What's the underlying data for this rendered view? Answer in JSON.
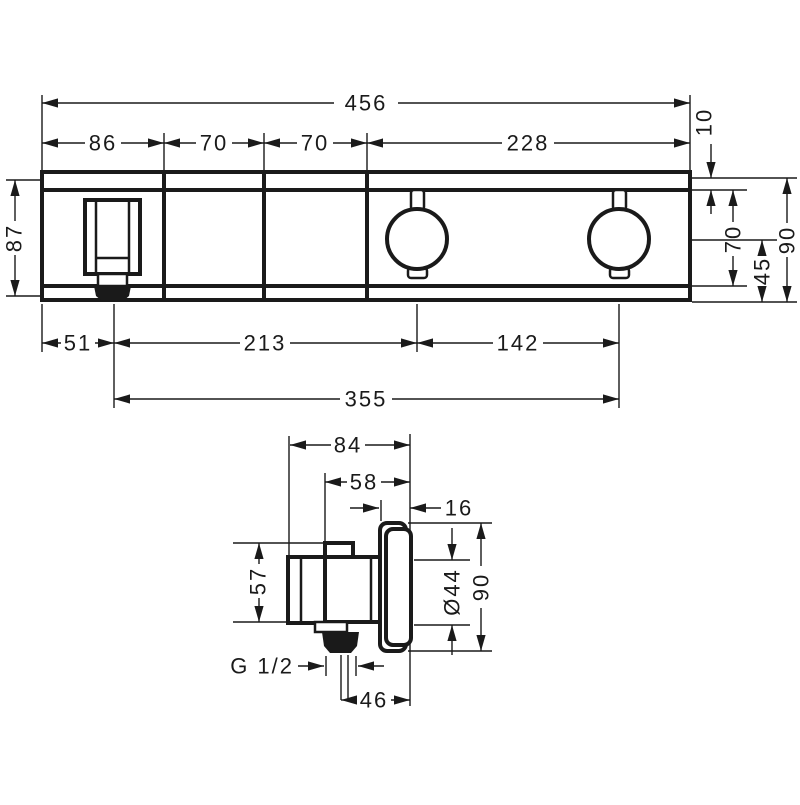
{
  "drawing": {
    "ink_color": "#1a1a1a",
    "background_color": "#ffffff",
    "front_view": {
      "top_dims": {
        "total_width": "456",
        "segment_holder": "86",
        "segment_gap1": "70",
        "segment_gap2": "70",
        "segment_knobs": "228",
        "top_edge_offset": "10"
      },
      "left_dim": {
        "body_height": "87"
      },
      "right_dims": {
        "faceplate_height": "70",
        "half_height": "45",
        "total_height": "90"
      },
      "bottom_dims": {
        "edge_to_holder": "51",
        "holder_to_knob1": "213",
        "knob1_to_knob2": "142",
        "holder_to_knob2_total": "355"
      }
    },
    "side_view": {
      "top_dims": {
        "total_depth": "84",
        "body_depth": "58",
        "plate_depth": "16"
      },
      "left_dim": {
        "body_height": "57"
      },
      "right_dims": {
        "knob_diameter": "Ø44",
        "plate_height": "90"
      },
      "bottom_dims": {
        "thread_size": "G 1/2",
        "outlet_to_front": "46"
      }
    }
  }
}
